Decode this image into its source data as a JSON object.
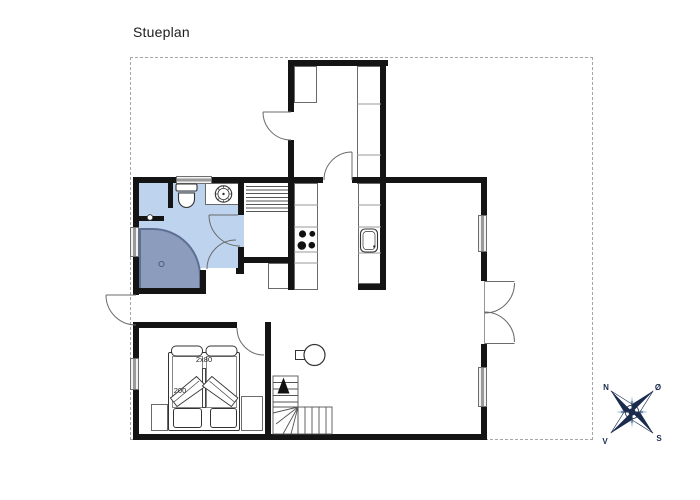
{
  "title": "Stueplan",
  "bed": {
    "width_label": "2x80",
    "length_label": "200"
  },
  "compass": {
    "north": "N",
    "east": "Ø",
    "south": "S",
    "west": "V"
  },
  "colors": {
    "wall": "#141414",
    "bathroom_fill": "#bed3ee",
    "shower_fill": "#8b9cbd",
    "shower_border": "#5f6f94",
    "fixture_line": "#444444",
    "compass_navy": "#1b2b4d",
    "compass_light": "#b9d2e9",
    "boundary_dash": "#a6a6a6"
  },
  "icons": [
    "toilet-icon",
    "washbasin-icon",
    "shower-icon",
    "stove-burners-icon",
    "kitchen-sink-icon",
    "wood-stove-icon",
    "stairs-up-arrow-icon",
    "door-arc-icon",
    "window-icon",
    "compass-rose-icon"
  ]
}
